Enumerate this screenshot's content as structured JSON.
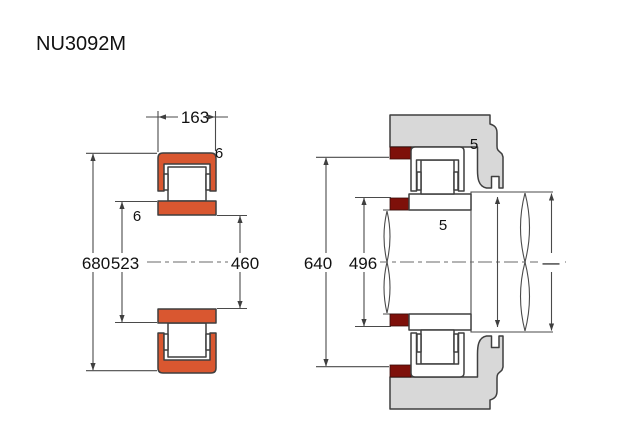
{
  "title": "NU3092M",
  "colors": {
    "background": "#ffffff",
    "ring_orange": "#d95730",
    "seal_dark_red": "#7e100a",
    "housing_gray": "#d8d8d8",
    "outline": "#3f3f3f",
    "dimension_line": "#4a4a4a",
    "text": "#111111"
  },
  "left_view": {
    "name": "bearing-cross-section",
    "width_label": "163",
    "outer_chamfer_label": "6",
    "inner_chamfer_label": "6",
    "outer_diameter_label": "680",
    "flange_diameter_label": "523",
    "bore_diameter_label": "460"
  },
  "right_view": {
    "name": "mounted-arrangement",
    "housing_abutment_label": "640",
    "shaft_abutment_label": "496",
    "clearance_top_label": "5",
    "clearance_mid_label": "5",
    "unspecified_dim_label": "—"
  }
}
